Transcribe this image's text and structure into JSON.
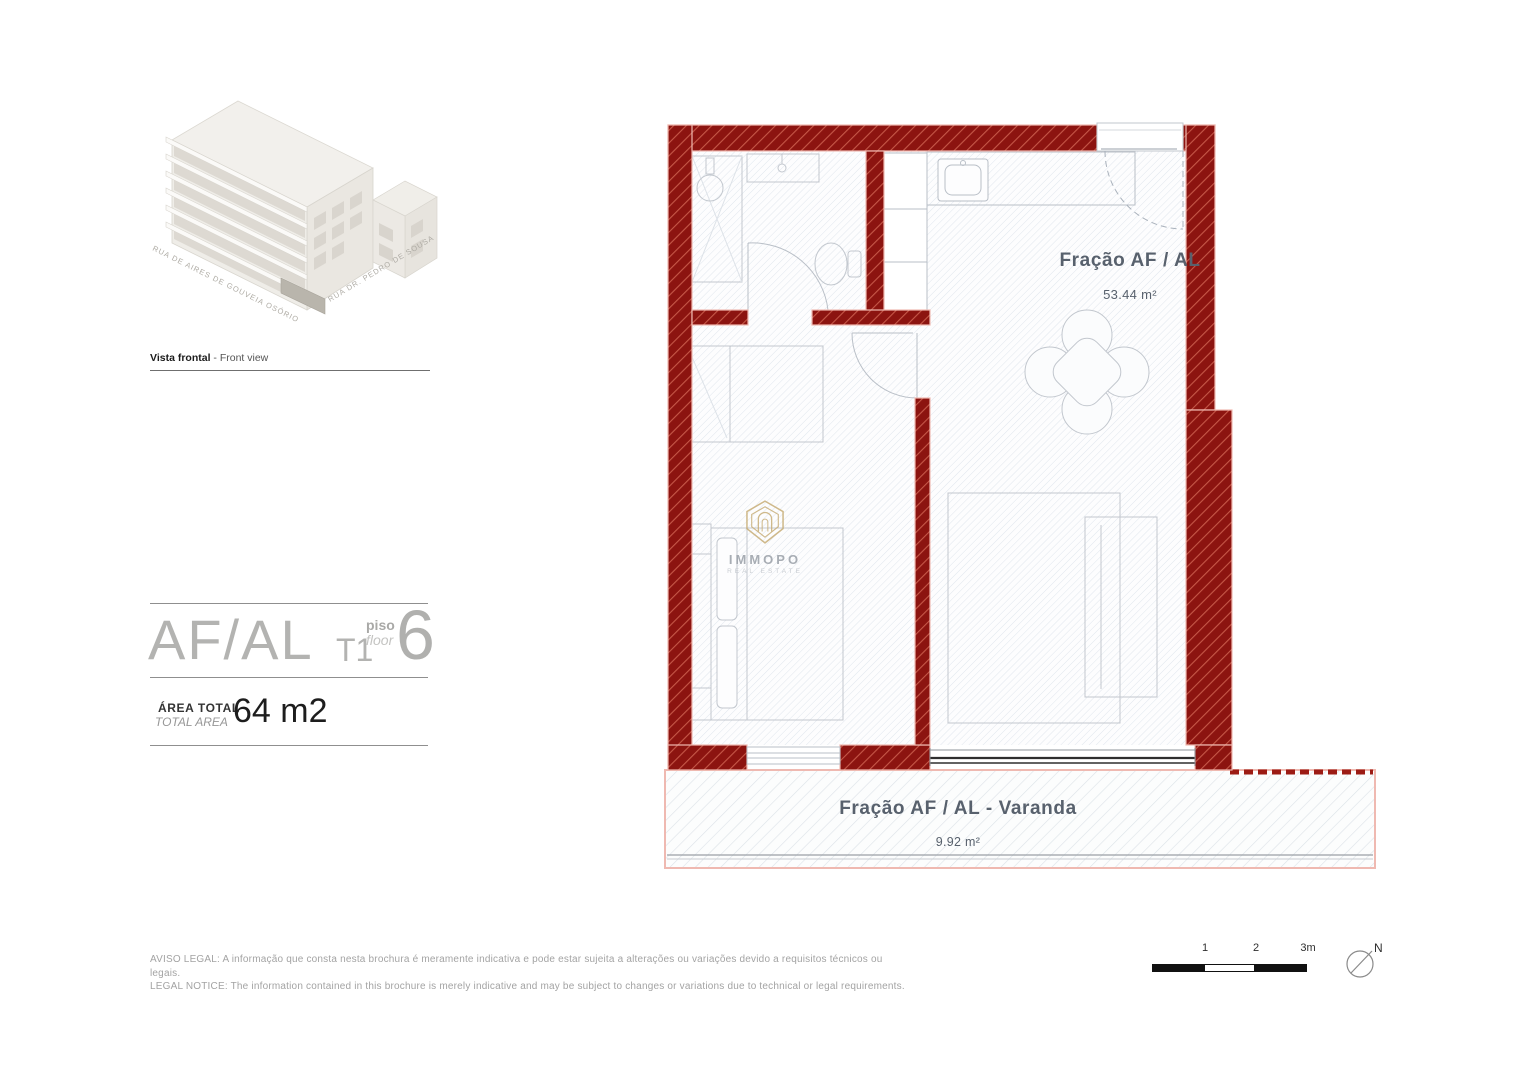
{
  "front_view": {
    "caption_bold": "Vista frontal",
    "caption_rest": " - Front view",
    "street_left": "RUA DE AIRES DE GOUVEIA OSÓRIO",
    "street_right": "RUA DR. PEDRO DE SOUSA"
  },
  "title_block": {
    "unit": "AF/AL",
    "typology": "T1",
    "floor_word_pt": "piso",
    "floor_word_en": "floor",
    "floor_number": "6",
    "area_word_pt": "ÁREA TOTAL",
    "area_word_en": "TOTAL AREA",
    "area_value": "64 m2"
  },
  "plan": {
    "unit_label": "Fração AF / AL",
    "unit_area": "53.44 m²",
    "balcony_label": "Fração AF / AL - Varanda",
    "balcony_area": "9.92 m²",
    "colors": {
      "wall": "#8c1410",
      "wall_hatch": "#c65848",
      "wall_outline": "#efb9b1",
      "floor_hatch": "#dee4ec",
      "label_text": "#58616d"
    }
  },
  "logo": {
    "name": "IMMOPO",
    "subtitle": "REAL ESTATE",
    "accent": "#c8ae77"
  },
  "legal": {
    "line1": "AVISO LEGAL: A informação que consta nesta brochura é meramente indicativa e pode estar sujeita a alterações ou variações devido a requisitos técnicos ou legais.",
    "line2": "LEGAL NOTICE: The information contained in this brochure is merely indicative and may be subject to changes or variations due to technical or legal requirements."
  },
  "scale_bar": {
    "tick1": "1",
    "tick2": "2",
    "tick3": "3m"
  },
  "compass": {
    "north": "N"
  }
}
